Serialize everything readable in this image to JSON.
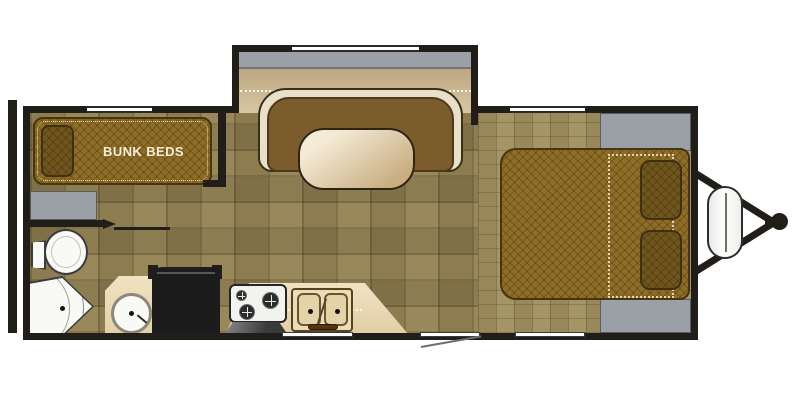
{
  "floorplan": {
    "labels": {
      "bunk_beds": "BUNK BEDS"
    },
    "colors": {
      "wall": "#211e19",
      "floor_base": "#8d7c50",
      "floor_fine": "#98885a",
      "slide_floor_top": "#b49a74",
      "slide_floor_bottom": "#d8c7a4",
      "exterior_gray": "#9ba0a7",
      "mattress": "#8e6d27",
      "pillow": "#70561d",
      "quilt_dot": "#ead9a8",
      "cushion": "#7c5b2d",
      "upholstery_cream": "#eae0c8",
      "table_light": "#f4ebd6",
      "table_dark": "#c9ae82",
      "counter": "#eddcb8",
      "sink_basin": "#e4d3a8",
      "fixture_white": "#f9f9f6",
      "appliance_black": "#1c1c1c",
      "faucet_brown": "#58330f",
      "door_swing_gray": "#6e6e6e"
    },
    "fixtures": [
      "rear-bumper",
      "bunk-beds",
      "under-bunk-cabinet",
      "toilet",
      "corner-shower",
      "vanity-sink",
      "refrigerator",
      "range-oven",
      "double-kitchen-sink",
      "u-shaped-dinette",
      "dinette-table",
      "dinette-slide-out",
      "queen-bed",
      "pillows",
      "wardrobe-front",
      "wardrobe-foot",
      "entry-door",
      "windows",
      "propane-tank-cover",
      "a-frame-tongue",
      "hitch-coupler"
    ]
  }
}
